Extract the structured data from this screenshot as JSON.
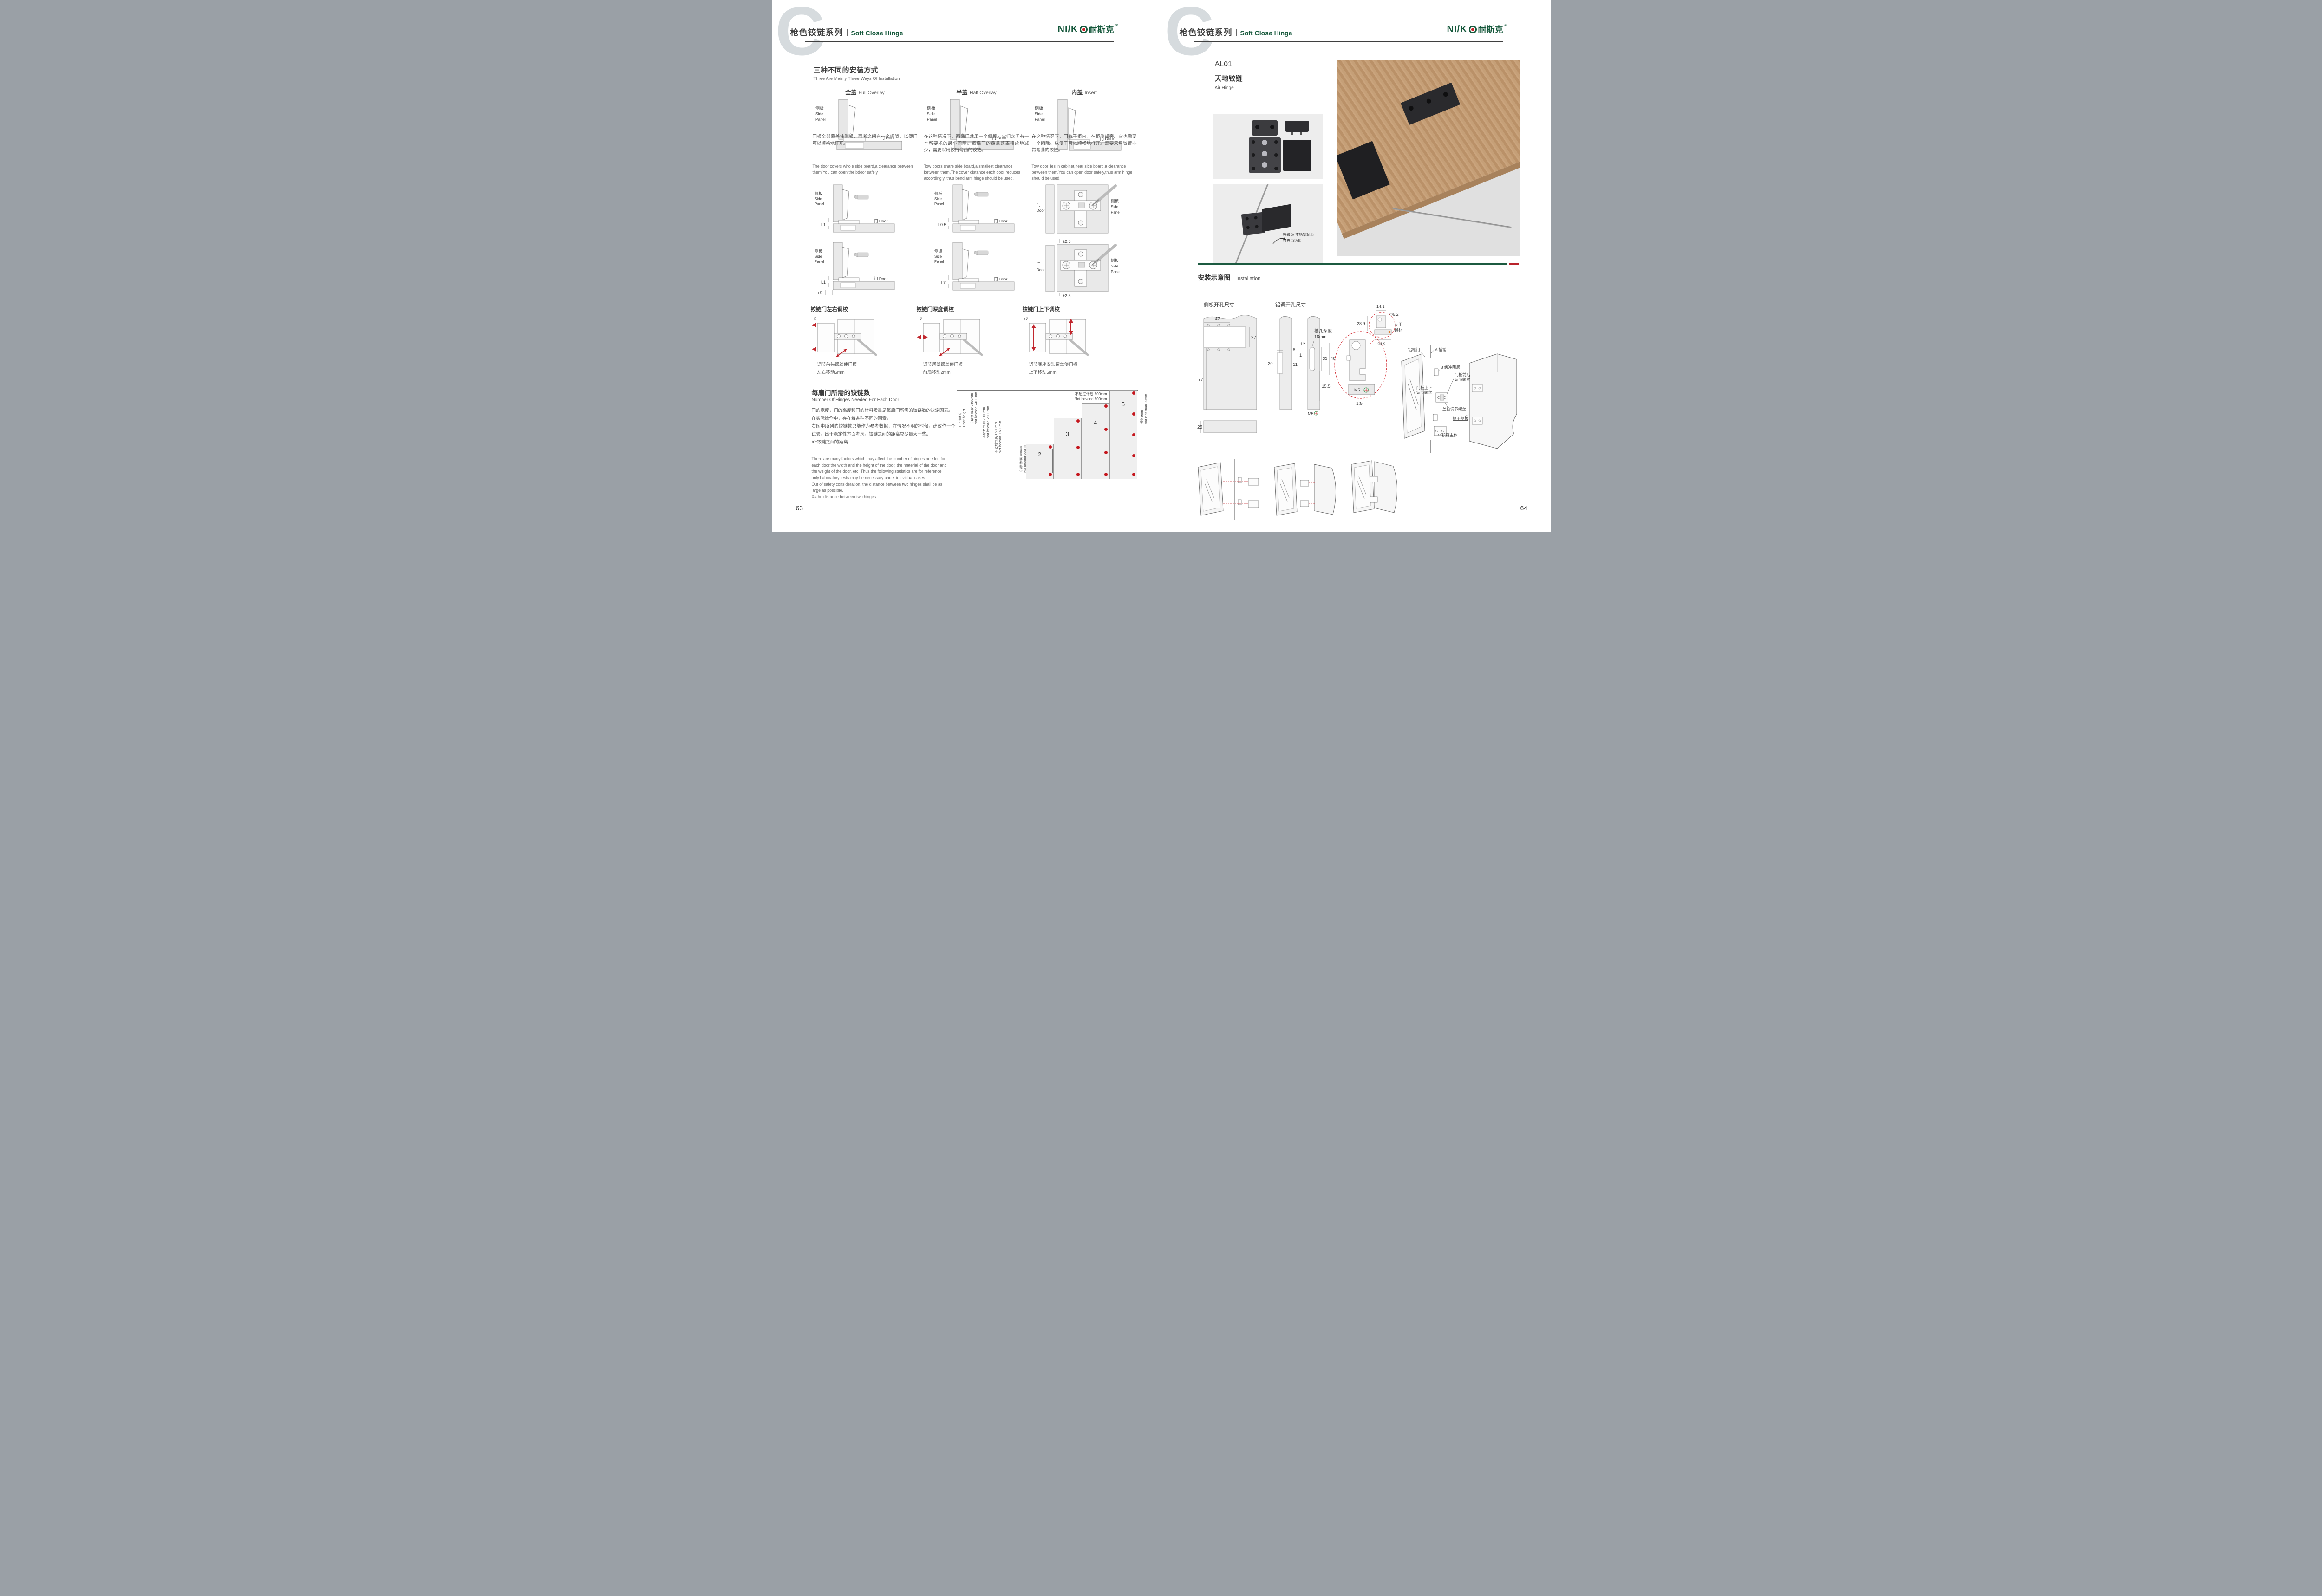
{
  "header": {
    "watermark": "C",
    "series_cn": "枪色铰链系列",
    "series_en": "Soft Close Hinge",
    "brand_latin": "NI/K",
    "brand_cn": "耐斯克",
    "reg": "®"
  },
  "labels": {
    "side_cn": "侧板",
    "side_en1": "Side",
    "side_en2": "Panel",
    "door": "门 Door",
    "door_cn": "门",
    "door_en": "Door"
  },
  "left": {
    "install": {
      "title_cn": "三种不同的安装方式",
      "title_en": "Three Are Mainly Three Ways Of Installation",
      "items": [
        {
          "name_cn": "全盖",
          "name_en": "Full Overlay",
          "desc_cn": "门板全部覆盖住侧板，两者之间有一个间隙，以便门可以顺畅地打开。",
          "desc_en": "The door covers whole side board,a clearance between them,You can open the bdoor safely."
        },
        {
          "name_cn": "半盖",
          "name_en": "Half Overlay",
          "desc_cn": "在这种情况下，两扇门共用一个侧板。它们之间有一个所要求的最小间隙。每扇门的覆盖距离相应地减少，需要采用铰臂弯曲的铰链。",
          "desc_en": "Tow doors share side board,a smallest clearance between them,The cover distance each door reduces accordingly, thus bend arm hinge should be used."
        },
        {
          "name_cn": "内盖",
          "name_en": "Insert",
          "desc_cn": "在这种情况下，门位于柜内，在柜侧板旁。它也需要一个间隙。以便于可以顺畅地打开。需要采用铰臂非常弯曲的铰链。",
          "desc_en": "Tow door lies in cabinet,near side board,a clearance between them.You can open door safely,thus arm hinge should be used."
        }
      ]
    },
    "offsets": {
      "d0": "L1",
      "d1": "L0.5",
      "d2": "L1",
      "d2b": "+5",
      "d3": "L7",
      "plate": "±2.5"
    },
    "adjust": [
      {
        "title": "铰链门左右调校",
        "range": "±5",
        "cap1": "调节前头螺丝使门板",
        "cap2": "左右移动5mm"
      },
      {
        "title": "铰链门深度调校",
        "range": "±2",
        "cap1": "调节尾部螺丝使门板",
        "cap2": "前后移动2mm"
      },
      {
        "title": "铰链门上下调校",
        "range": "±2",
        "cap1": "调节底座安装螺丝使门板",
        "cap2": "上下移动5mm"
      }
    ],
    "hinges": {
      "title_cn": "每扇门所需的铰链数",
      "title_en": "Number Of Hinges Needed For Each Door",
      "cn1": "门的宽度，门的高度和门的材料质量是每扇门所需的铰链数的决定因素。",
      "cn2": "在实际操作中，存在着各种不同的因素。",
      "cn3": "右图中所列的铰链数只能作为参考数据，在情况不明的时候，建议作一个试验，出于稳定性方面考虑，铰链之间的距离应尽量大一些。",
      "cn4": "X=铰链之间的距离",
      "en1": "There are many factors which may affect the number of hinges needed for each door.the width and the height of the door, the material of the door and the weight of the door, etc, Thus the following statistics are for reference only.Laboratory tests may be necessary under individual cases.",
      "en2": "Out of safety consideration, the distance between two hinges shall be as large as possible.",
      "en3": "X=the distance between two hinges"
    },
    "chart": {
      "door_cn": "门的高度",
      "door_en": "Door height",
      "levels": [
        {
          "cn": "不超过计划 2400mm",
          "en": "Not bevond 2400mm"
        },
        {
          "cn": "不超过计划 2000mm",
          "en": "Not bevond 2000mm"
        },
        {
          "cn": "不超过计划 1600mm",
          "en": "Not bevond 1600mm"
        },
        {
          "cn": "不超过计划 900mm",
          "en": "Not bevond 900mm"
        }
      ],
      "width_cn": "不超过计划 600mm",
      "width_en": "Not bevond 600mm",
      "min_cn": "至少 90mm",
      "min_en": "Not less than 90mm",
      "bars": [
        "2",
        "3",
        "4",
        "5"
      ]
    },
    "page_no": "63"
  },
  "right": {
    "product": {
      "code": "AL01",
      "name_cn": "天地铰链",
      "name_en": "Air Hinge",
      "note1": "升级版·不锈钢轴心",
      "note2": "可自由拆卸"
    },
    "install": {
      "title_cn": "安装示意图",
      "title_en": "Installation"
    },
    "tech": {
      "side_label": "侧板开孔尺寸",
      "alu_label": "铝调开孔尺寸",
      "slot1": "槽孔深度",
      "slot2": "18mm",
      "d47": "47",
      "d27": "27",
      "d77": "77",
      "d25": "25",
      "d8": "8",
      "d20": "20",
      "d11": "11",
      "d12": "12",
      "d1": "1",
      "d33": "33",
      "d46": "46",
      "d155": "15.5",
      "m5": "M5",
      "m5b": "M5",
      "scale": "1:5",
      "d141": "14.1",
      "d289": "28.9",
      "d62": "Φ6.2",
      "d349": "34.9",
      "alu1": "专用",
      "alu2": "铝材"
    },
    "exploded": {
      "door": "铝框门",
      "pin": "A 插销",
      "damper": "B 缓冲阻尼",
      "fb1": "门板前后",
      "fb2": "调节螺丝",
      "ud1": "门板上下",
      "ud2": "调节螺丝",
      "overlay": "盖位调节螺丝",
      "side": "柜子侧板",
      "body": "C 铰链主体"
    },
    "page_no": "64"
  }
}
